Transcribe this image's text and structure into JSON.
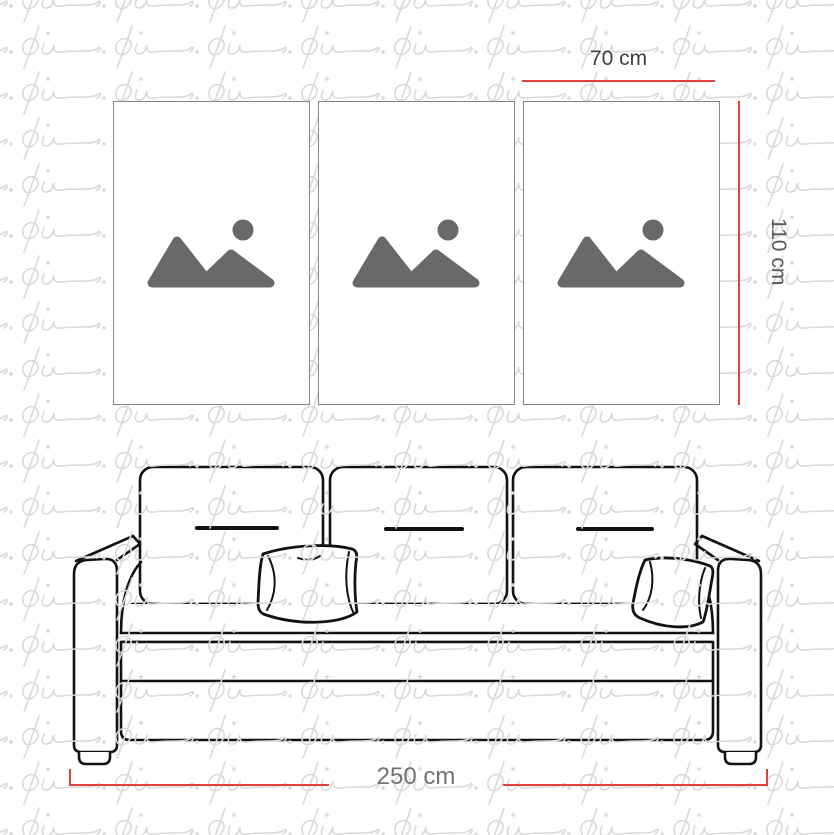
{
  "watermark": {
    "text": "pi.",
    "color": "#d9d9d9"
  },
  "artwork": {
    "panel_count": 3,
    "panels": [
      {
        "name": "panel-1",
        "icon": "image-placeholder"
      },
      {
        "name": "panel-2",
        "icon": "image-placeholder"
      },
      {
        "name": "panel-3",
        "icon": "image-placeholder"
      }
    ],
    "icon_color": "#696969",
    "border_color": "#858585"
  },
  "dimensions": {
    "line_color": "#e2423c",
    "panel_width": {
      "label": "70 cm",
      "color": "#3e3e40"
    },
    "panel_height": {
      "label": "110 cm",
      "color": "#58595b"
    },
    "sofa_width": {
      "label": "250 cm",
      "color": "#737276"
    }
  },
  "sofa": {
    "illustration": "three-seat sofa line drawing",
    "back_cushions": 3,
    "throw_pillows": 2,
    "stroke_color": "#121212"
  }
}
